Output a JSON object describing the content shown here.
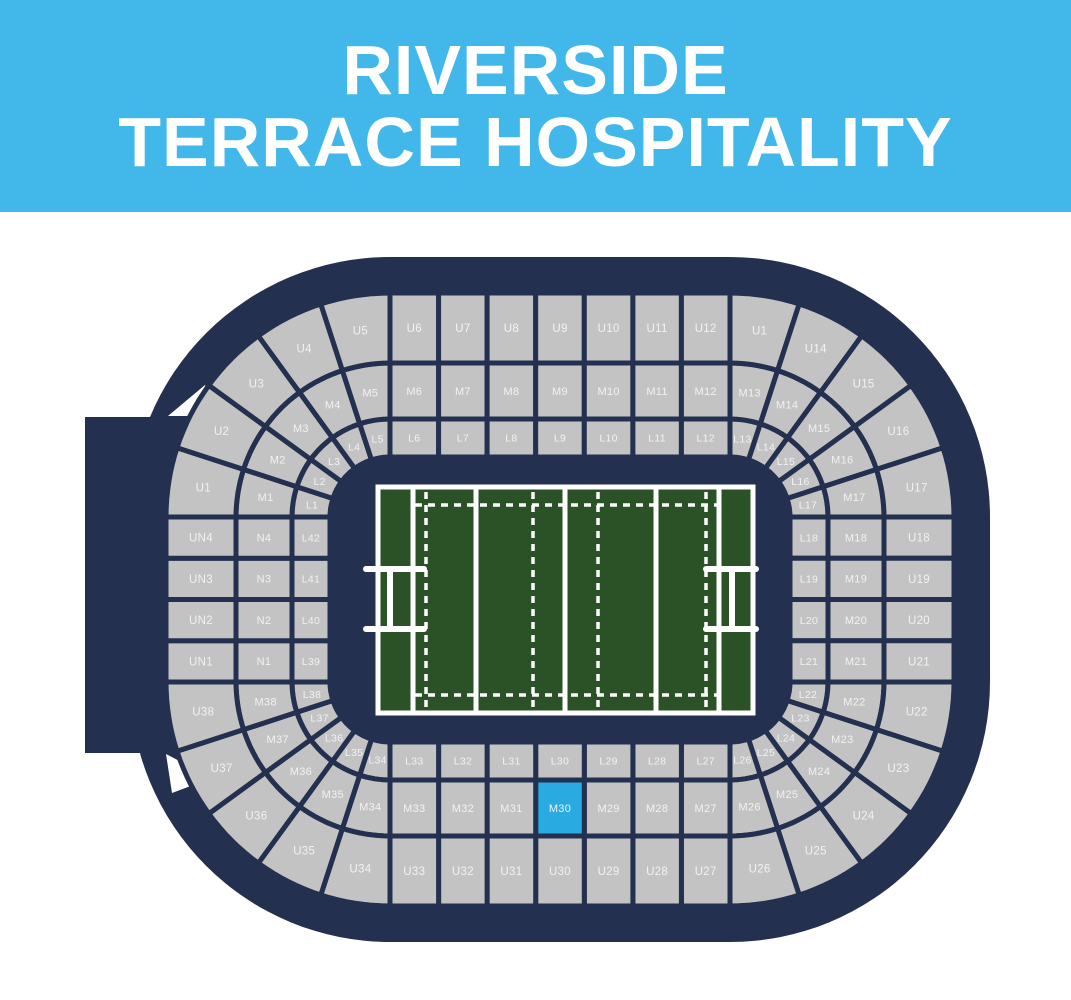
{
  "header": {
    "title_line1": "RIVERSIDE",
    "title_line2": "TERRACE HOSPITALITY"
  },
  "colors": {
    "header_bg": "#42B7EA",
    "header_text": "#FFFFFF",
    "background": "#FFFFFF",
    "stadium": "#233050",
    "section_fill": "#C3C3C3",
    "section_label": "#F2F2F2",
    "highlight": "#29ABE2",
    "pitch_green": "#2B5227",
    "pitch_line": "#FFFFFF"
  },
  "stadium": {
    "highlighted_section": "M30",
    "tiers": [
      {
        "name": "lower",
        "segments": {
          "tl": [
            "L1",
            "L2",
            "L3",
            "L4",
            "L5"
          ],
          "top": [
            "L6",
            "L7",
            "L8",
            "L9",
            "L10",
            "L11",
            "L12"
          ],
          "tr": [
            "L13",
            "L14",
            "L15",
            "L16",
            "L17"
          ],
          "right": [
            "L18",
            "L19",
            "L20",
            "L21"
          ],
          "br": [
            "L22",
            "L23",
            "L24",
            "L25",
            "L26"
          ],
          "bottom": [
            "L27",
            "L28",
            "L29",
            "L30",
            "L31",
            "L32",
            "L33"
          ],
          "bl": [
            "L34",
            "L35",
            "L36",
            "L37",
            "L38"
          ],
          "left": [
            "L39",
            "L40",
            "L41",
            "L42"
          ]
        }
      },
      {
        "name": "middle",
        "segments": {
          "tl": [
            "M1",
            "M2",
            "M3",
            "M4",
            "M5"
          ],
          "top": [
            "M6",
            "M7",
            "M8",
            "M9",
            "M10",
            "M11",
            "M12"
          ],
          "tr": [
            "M13",
            "M14",
            "M15",
            "M16",
            "M17"
          ],
          "right": [
            "M18",
            "M19",
            "M20",
            "M21"
          ],
          "br": [
            "M22",
            "M23",
            "M24",
            "M25",
            "M26"
          ],
          "bottom": [
            "M27",
            "M28",
            "M29",
            "M30",
            "M31",
            "M32",
            "M33"
          ],
          "bl": [
            "M34",
            "M35",
            "M36",
            "M37",
            "M38"
          ],
          "left": [
            "N1",
            "N2",
            "N3",
            "N4"
          ]
        }
      },
      {
        "name": "upper",
        "segments": {
          "tl": [
            "U1",
            "U2",
            "U3",
            "U4",
            "U5"
          ],
          "top": [
            "U6",
            "U7",
            "U8",
            "U9",
            "U10",
            "U11",
            "U12"
          ],
          "tr": [
            "U1",
            "U14",
            "U15",
            "U16",
            "U17"
          ],
          "right": [
            "U18",
            "U19",
            "U20",
            "U21"
          ],
          "br": [
            "U22",
            "U23",
            "U24",
            "U25",
            "U26"
          ],
          "bottom": [
            "U27",
            "U28",
            "U29",
            "U30",
            "U31",
            "U32",
            "U33"
          ],
          "bl": [
            "U34",
            "U35",
            "U36",
            "U37",
            "U38"
          ],
          "left": [
            "UN1",
            "UN2",
            "UN3",
            "UN4"
          ]
        }
      }
    ]
  }
}
